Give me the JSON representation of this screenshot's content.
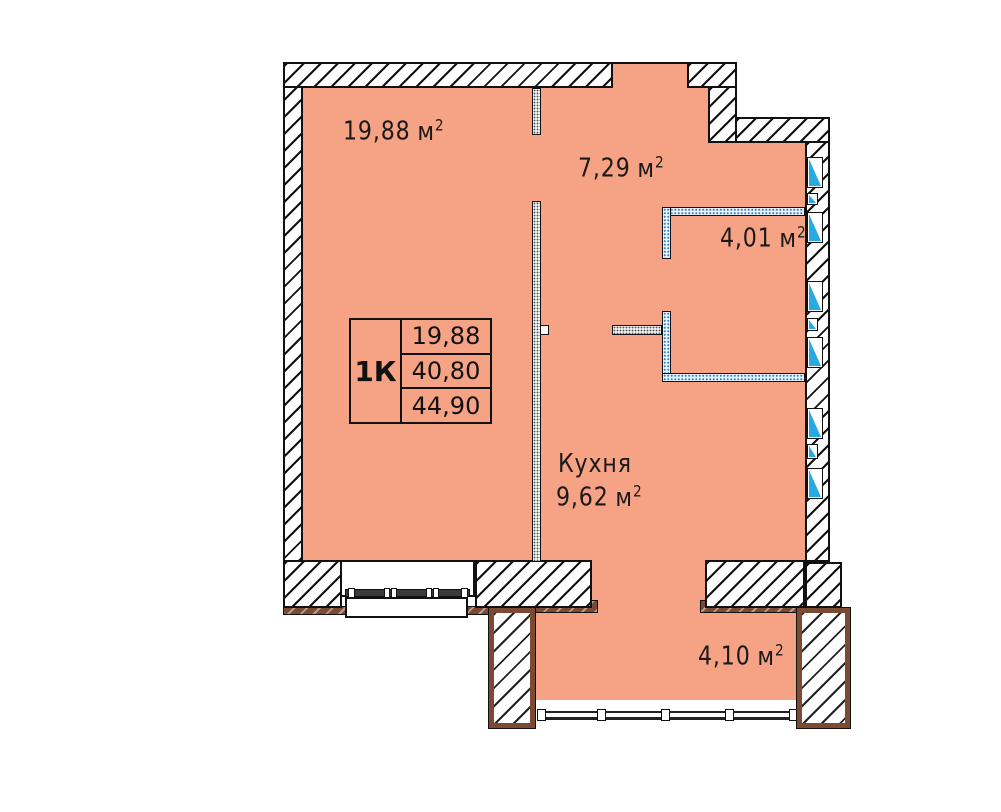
{
  "rooms": {
    "living": {
      "area": "19,88"
    },
    "hall": {
      "area": "7,29"
    },
    "bath": {
      "area": "4,01"
    },
    "kitchen": {
      "name": "Кухня",
      "area": "9,62"
    },
    "balcony": {
      "area": "4,10"
    }
  },
  "units": {
    "area_unit": "м",
    "sup": "2"
  },
  "summary": {
    "type": "1К",
    "rows": [
      "19,88",
      "40,80",
      "44,90"
    ]
  },
  "colors": {
    "floor": "#F6A285",
    "vent_blue": "#29A9E1",
    "balcony_brown": "#7B4A33",
    "wet_wall_blue": "#2F7FC1"
  }
}
